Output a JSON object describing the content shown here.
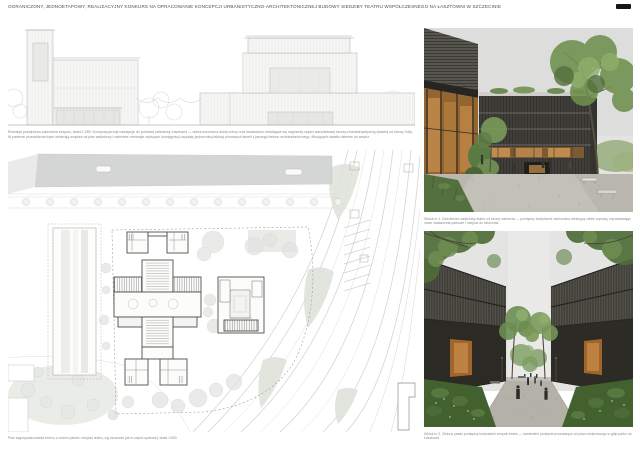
{
  "header": {
    "title": "OGRANICZONY, JEDNOETAPOWY, REALIZACYJNY KONKURS NA OPRACOWANIE KONCEPCJI URBANISTYCZNO-ARCHITEKTONICZNEJ BUDOWY SIEDZIBY TEATRU WSPÓŁCZESNEGO NA ŁASZTOWNI W SZCZECINIE"
  },
  "elevation_panel": {
    "caption_line1": "Elewacja południowo-zachodnia zespołu, skala 1:250. Kompozycja brył nawiązuje do portowej zabudowy Łasztowni — wieża sceniczna dużej sceny oraz kaskadowo obniżające się segmenty części warsztatowej tworzą charakterystyczną sylwetę od strony Odry.",
    "caption_line2": "W parterze przeszklenia foyer otwierają wnętrza na plac wejściowy i nabrzeże; elewacje wyższych kondygnacji uzyskały jednorodną fakturę pionowych lameli z jasnego betonu architektonicznego, filtrujących światło dzienne do wnętrz."
  },
  "site_plan_panel": {
    "caption": "Plan zagospodarowania terenu z rzutem parteru zespołu teatru, wg oznaczeń jak w części opisowej, skala 1:500",
    "scale": "1:500"
  },
  "renders": [
    {
      "caption": "Widok nr 1. Dziedziniec wejściowy teatru od strony nabrzeża — pomiędzy budynkami zachowano istniejącą zieleń wysoką, wprowadzając nowe nasadzenia parkowe i miejsca do siedzenia."
    },
    {
      "caption": "Widok nr 2. Zielony pasaż pomiędzy budynkami zespołu teatru — kameralne przejście prowadzące od placu wejściowego w głąb parku na Łasztowni."
    }
  ],
  "icons": {
    "page_badge": "page-number-bar"
  },
  "colors": {
    "header_text": "#4f4f4f",
    "badge_black": "#161616",
    "linework_light": "#b9b9b7",
    "plan_water": "#d4d6d5",
    "plan_building_outline": "#4f4f4d",
    "render_dark_facade": "#33322c",
    "render_wood_glazing": "#a1652c",
    "render_wood_glow": "#c08445",
    "render_green_dark": "#4f6c39",
    "render_green_mid": "#6e8f4e",
    "render_green_light": "#8db06a",
    "render_gravel": "#b7b4ac",
    "render_sky": "#e3e4e2"
  }
}
